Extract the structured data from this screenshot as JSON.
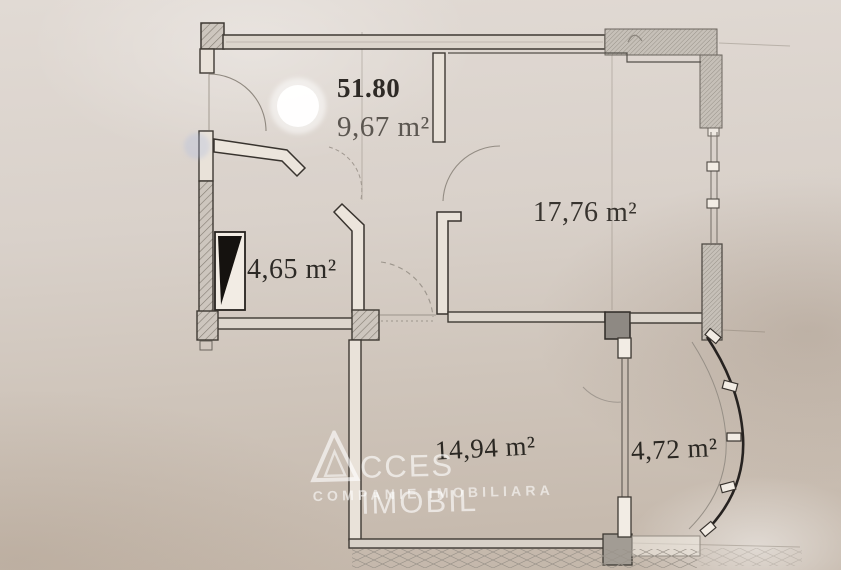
{
  "plan": {
    "total_area": "51.80",
    "rooms": [
      {
        "id": "hallway",
        "area": "9,67 m²"
      },
      {
        "id": "living-room",
        "area": "17,76 m²"
      },
      {
        "id": "bathroom",
        "area": "4,65 m²"
      },
      {
        "id": "bedroom",
        "area": "14,94 m²"
      },
      {
        "id": "balcony",
        "area": "4,72 m²"
      }
    ]
  },
  "watermark": {
    "logo_letter": "A",
    "brand": "CCES IMOBIL",
    "tagline": "COMPANIE IMOBILIARA"
  },
  "colors": {
    "ink": "#3a3530",
    "paper_light": "#e1dad4",
    "paper_dark": "#c3b6a9",
    "wall_fill": "#e9e2d9",
    "watermark": "rgba(255,255,255,0.6)"
  }
}
